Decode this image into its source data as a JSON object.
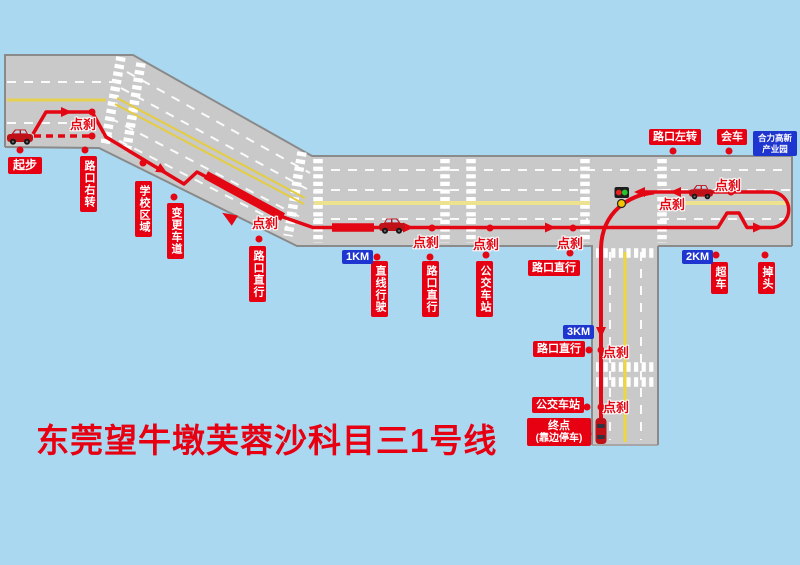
{
  "title": "东莞望牛墩芙蓉沙科目三1号线",
  "labels": {
    "start": "起步",
    "turn_right": "路口右转",
    "tap_brake": "点刹",
    "school_zone": "学校区域",
    "change_lane": "变更车道",
    "cross_straight": "路口直行",
    "straight_driving": "直线行驶",
    "bus_station": "公交车站",
    "cross_left_turn": "路口左转",
    "meet_vehicle": "会车",
    "overtake": "超车",
    "u_turn": "掉头",
    "end_line1": "终点",
    "end_line2": "(靠边停车)",
    "industrial_park_line1": "合力高新",
    "industrial_park_line2": "产业园"
  },
  "km_markers": {
    "km1": "1KM",
    "km2": "2KM",
    "km3": "3KM"
  },
  "colors": {
    "sky": "#aad8f1",
    "road": "#c9c9c9",
    "road_edge": "#8a8a8a",
    "lane_white": "#ffffff",
    "lane_yellow": "#e6d14e",
    "route_red": "#e30613",
    "label_red": "#e60012",
    "label_blue": "#1e36cf",
    "title_red": "#e60012"
  },
  "icons": {
    "car": "car-icon",
    "traffic_light": "traffic-light-icon"
  }
}
